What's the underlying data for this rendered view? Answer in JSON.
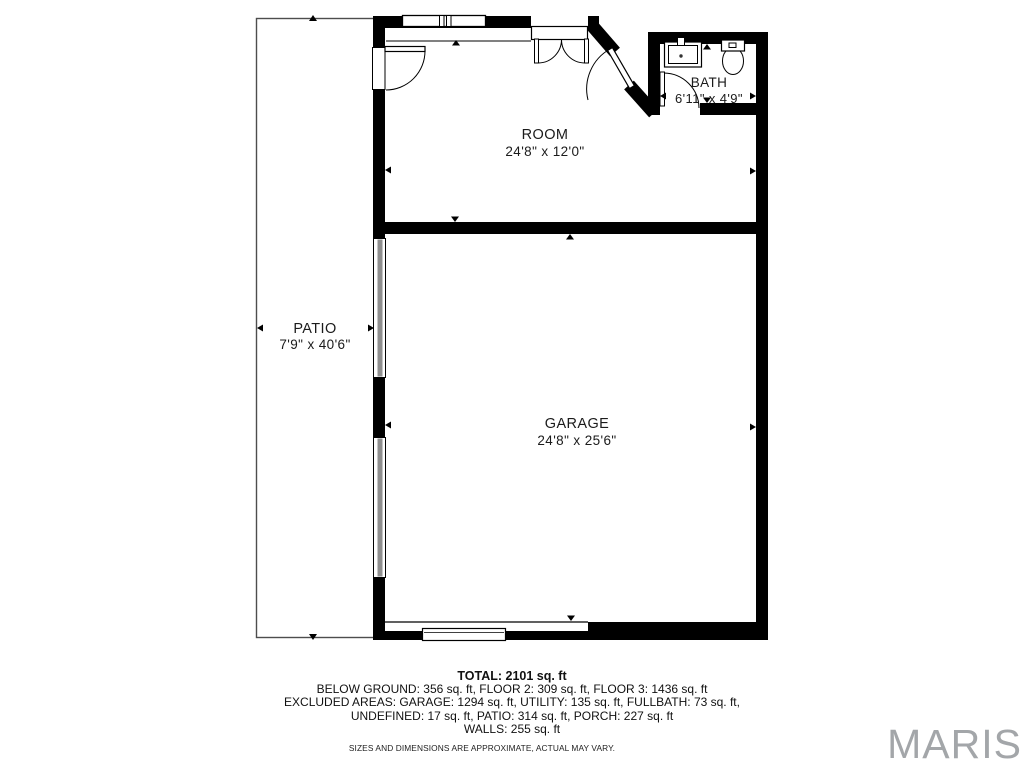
{
  "floor_plan": {
    "patio": {
      "label": "PATIO",
      "dimensions": "7'9\" x 40'6\""
    },
    "room": {
      "label": "ROOM",
      "dimensions": "24'8\" x 12'0\""
    },
    "bath": {
      "label": "BATH",
      "dimensions": "6'11\" x 4'9\""
    },
    "garage": {
      "label": "GARAGE",
      "dimensions": "24'8\" x 25'6\""
    }
  },
  "summary": {
    "total": "TOTAL: 2101 sq. ft",
    "lines": [
      "BELOW GROUND: 356 sq. ft, FLOOR 2: 309 sq. ft, FLOOR 3: 1436 sq. ft",
      "EXCLUDED AREAS: GARAGE: 1294 sq. ft, UTILITY: 135 sq. ft, FULLBATH: 73 sq. ft,",
      "UNDEFINED: 17 sq. ft, PATIO: 314 sq. ft, PORCH: 227 sq. ft",
      "WALLS: 255 sq. ft"
    ],
    "disclaimer": "SIZES AND DIMENSIONS ARE APPROXIMATE, ACTUAL MAY VARY."
  },
  "watermark": {
    "text": "MARIS",
    "color": "#a3a6a9"
  },
  "colors": {
    "wall": "#000000",
    "screen_panel": "#8f8f8f",
    "patio_outline": "#4d4d4d",
    "background": "#ffffff"
  }
}
